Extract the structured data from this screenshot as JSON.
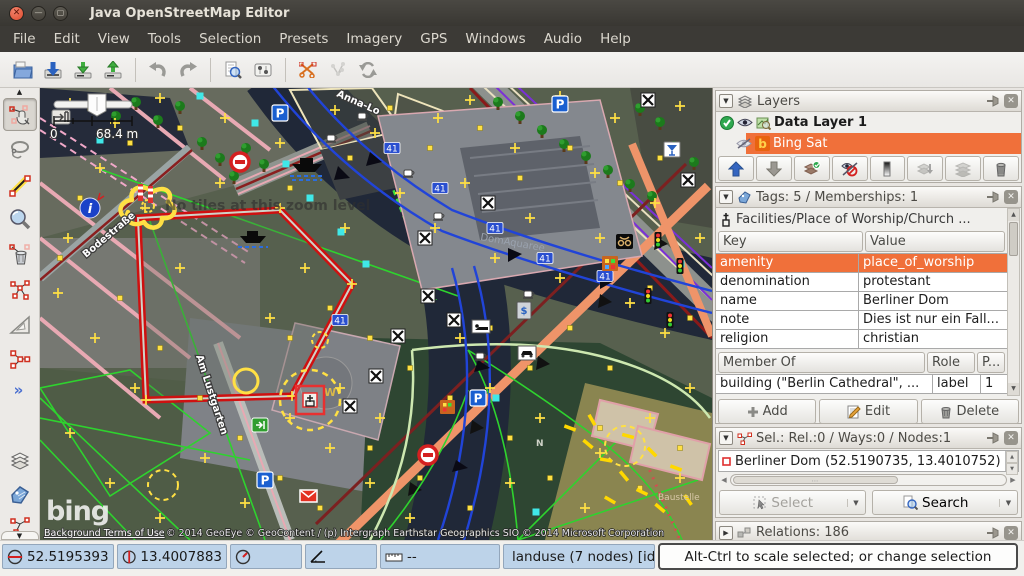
{
  "window": {
    "title": "Java OpenStreetMap Editor"
  },
  "menu": {
    "items": [
      "File",
      "Edit",
      "View",
      "Tools",
      "Selection",
      "Presets",
      "Imagery",
      "GPS",
      "Windows",
      "Audio",
      "Help"
    ]
  },
  "toolbar": {
    "icons": [
      "open",
      "save",
      "download-data",
      "upload-data",
      "undo",
      "redo",
      "zoom-to-download",
      "preferences",
      "split-way",
      "combine-way",
      "update-data"
    ]
  },
  "editbar": {
    "icons": [
      "select-tool",
      "lasso-tool",
      "draw-nodes-tool",
      "zoom-tool",
      "delete-tool",
      "unglue-tool",
      "angle-snap-tool",
      "merge-nodes-tool",
      "more-tools",
      "layers-dialog",
      "tags-dialog",
      "selection-dialog"
    ],
    "more_label": "»"
  },
  "map": {
    "labels": {
      "scale_min": "0",
      "scale_max": "68.4 m",
      "no_tiles": "No tiles at this zoom level",
      "dom_aquaree": "DomAquaree",
      "street_anna": "Anna-Lo",
      "street_bode": "Bodestraße",
      "street_lust": "Am Lustgarten",
      "baustelle": "Baustelle",
      "bing": "bing",
      "terms": "Background Terms of Use",
      "copyright": "© 2014 GeoEye © GeoContent / (p) Intergraph Earthstar Geographics SIO © 2014 Microsoft Corporation",
      "sign_p": "P",
      "sign_41": "41",
      "sign_w": "W",
      "info_i": "i",
      "letter_n": "N"
    }
  },
  "panels": {
    "layers": {
      "title": "Layers",
      "rows": [
        {
          "name": "Data Layer 1",
          "active": true,
          "visible": true
        },
        {
          "name": "Bing Sat",
          "selected": true,
          "visible": false,
          "icon_letter": "b"
        }
      ],
      "buttons": [
        "move-up",
        "move-down",
        "activate-layer",
        "show-hide",
        "opacity",
        "merge-down",
        "duplicate-layer",
        "delete-layer"
      ]
    },
    "tags": {
      "title": "Tags: 5 / Memberships: 1",
      "preset": "Facilities/Place of Worship/Church ...",
      "columns": [
        "Key",
        "Value"
      ],
      "rows": [
        [
          "amenity",
          "place_of_worship"
        ],
        [
          "denomination",
          "protestant"
        ],
        [
          "name",
          "Berliner Dom"
        ],
        [
          "note",
          "Dies ist nur ein Fall..."
        ],
        [
          "religion",
          "christian"
        ]
      ],
      "member_columns": [
        "Member Of",
        "Role",
        "P..."
      ],
      "memberships": [
        [
          "building (\"Berlin Cathedral\", ...",
          "label",
          "1"
        ]
      ],
      "buttons": {
        "add": "Add",
        "edit": "Edit",
        "delete": "Delete"
      }
    },
    "selection": {
      "title": "Sel.: Rel.:0 / Ways:0 / Nodes:1",
      "items": [
        "Berliner Dom (52.5190735, 13.4010752)"
      ],
      "select_label": "Select",
      "search_label": "Search"
    },
    "relations": {
      "title": "Relations: 186"
    }
  },
  "statusbar": {
    "lat": "52.5195393",
    "lon": "13.4007883",
    "heading": "",
    "angle": "",
    "distance": "--",
    "object_info": "landuse (7 nodes) [id: ...",
    "help": "Alt-Ctrl to scale selected; or change selection"
  }
}
